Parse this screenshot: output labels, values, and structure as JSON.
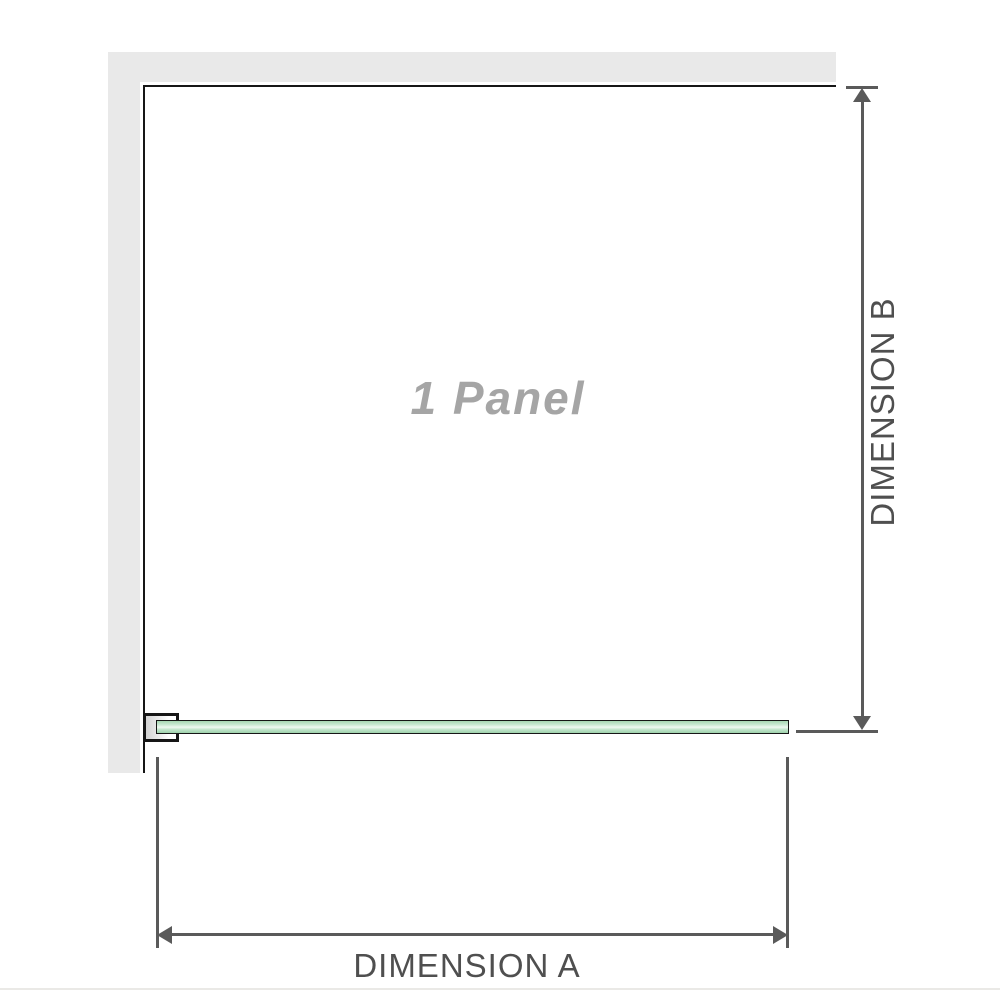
{
  "diagram": {
    "panel_label": "1 Panel",
    "dimensions": {
      "a_label": "DIMENSION A",
      "b_label": "DIMENSION B"
    },
    "colors": {
      "wall_gray": "#e9e9e9",
      "panel_outline_black": "#161616",
      "dimension_line_gray": "#5a5a5a",
      "dimension_text_gray": "#4f4f4f",
      "panel_label_gray": "#a5a5a5",
      "glass_green": "#a6d7b2",
      "glass_highlight": "#eef8f1"
    }
  }
}
